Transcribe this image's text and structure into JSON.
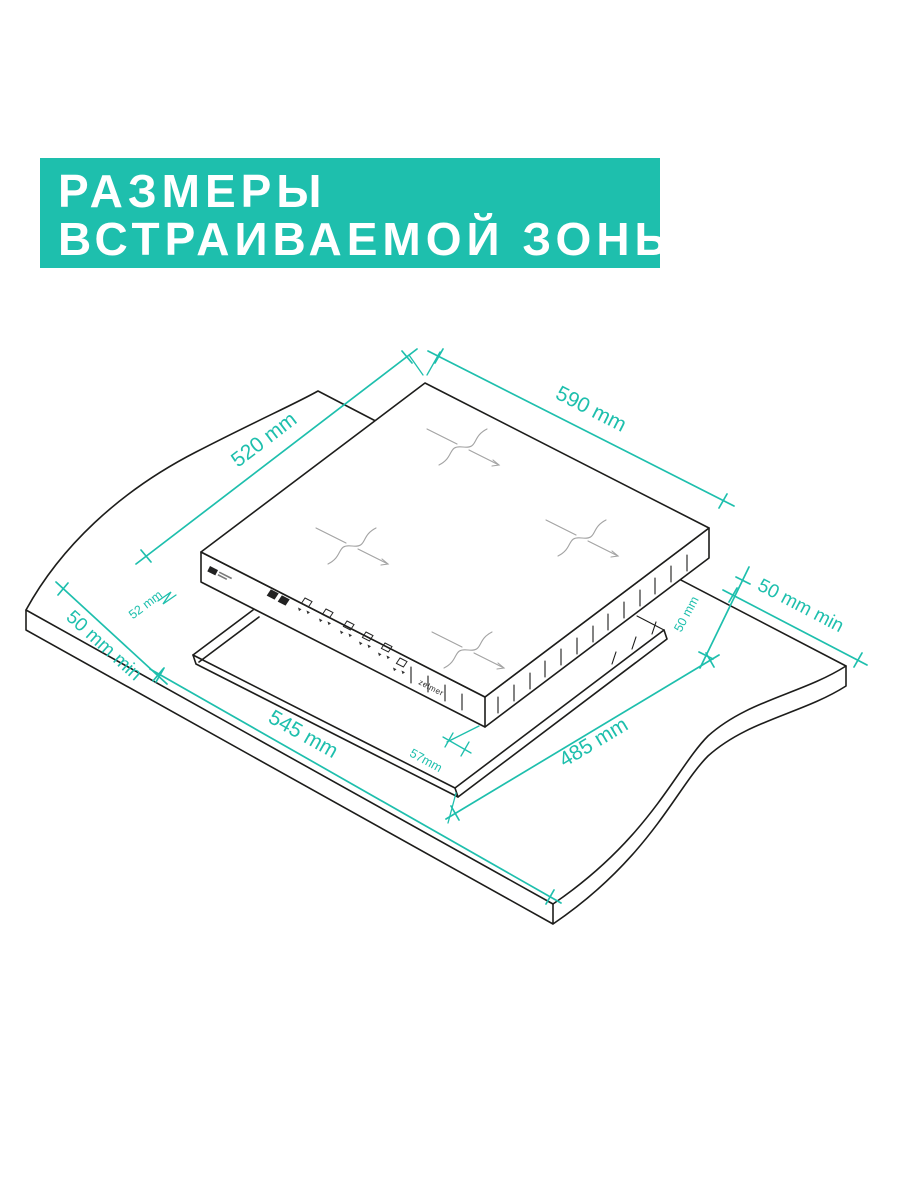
{
  "title": {
    "line1": "РАЗМЕРЫ",
    "line2": "ВСТРАИВАЕМОЙ ЗОНЫ"
  },
  "brand": "zelmer",
  "colors": {
    "accent_teal": "#1ebfad",
    "drawing_line": "#1d1d1b",
    "zone_mark_gray": "#a3a3a3",
    "background": "#ffffff"
  },
  "diagram": {
    "description": "Isometric installation drawing of a built-in induction hob above a worktop cutout",
    "dimensions": {
      "hob_top_depth": "520 mm",
      "hob_top_width": "590 mm",
      "hob_rim_height": "52 mm",
      "left_clearance": "50 mm min",
      "right_edge_gap": "50 mm",
      "right_clearance": "50 mm min",
      "cutout_width": "545 mm",
      "hob_body_height": "57mm",
      "cutout_depth": "485 mm"
    },
    "icons": {
      "zone_marks": "pot-position-crosshair",
      "control_panel": "touch-control-keys",
      "glass_logo": "glass-brand-mark"
    }
  }
}
